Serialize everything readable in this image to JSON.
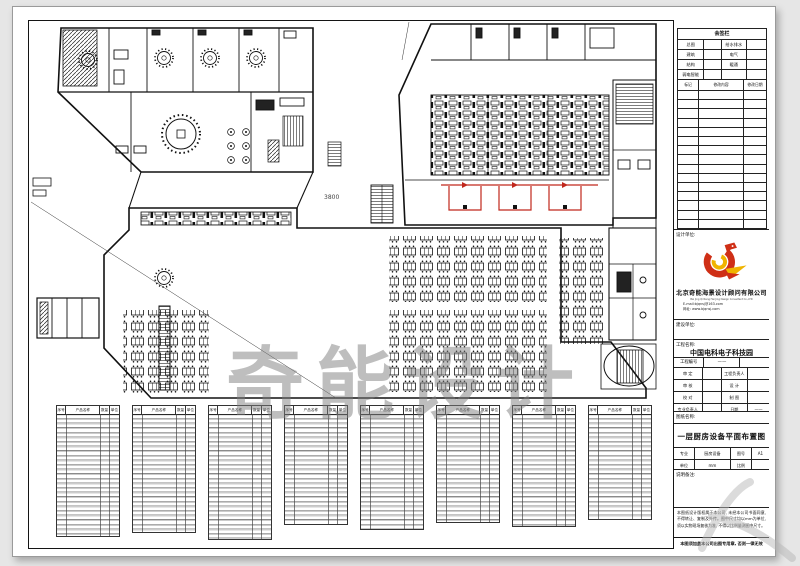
{
  "watermark": {
    "text": "奇能设计"
  },
  "plan": {
    "dim_label": "3800",
    "buffet_color": "#c0271c"
  },
  "signoff": {
    "title": "会签栏",
    "rows": [
      [
        "总图",
        "给水排水"
      ],
      [
        "建筑",
        "电气"
      ],
      [
        "结构",
        "暖通"
      ],
      [
        "弱电智能",
        ""
      ]
    ],
    "rev_headers": [
      "标记",
      "修改内容",
      "修改日期"
    ]
  },
  "design_unit": {
    "label": "设计单位:",
    "company_cn": "北京奇能海景设计顾问有限公司",
    "company_en": "Bei Jing Qi Neng Hai Jing Design Consultant Co.,LTD",
    "email": "E-mail:bjqnsj@163.com",
    "website": "网址: www.bjqnsj.com"
  },
  "project": {
    "owner_label": "建设单位:",
    "name_label": "工程名称:",
    "name": "中国电科电子科技园",
    "no_label": "工程编号",
    "no_value": "——",
    "approvals": [
      {
        "l": "审 定",
        "r": "工程负责人",
        "rv": ""
      },
      {
        "l": "审 核",
        "r": "设 计",
        "rv": ""
      },
      {
        "l": "校 对",
        "r": "制 图",
        "rv": ""
      },
      {
        "l": "专业负责人",
        "r": "日期",
        "rv": "——"
      }
    ]
  },
  "sheet": {
    "name_label": "图纸名称:",
    "title": "一层厨房设备平面布置图",
    "spec_rows": [
      [
        "专业",
        "厨房设备",
        "图号",
        "A1"
      ],
      [
        "单位",
        "mm",
        "比例",
        ""
      ]
    ],
    "remark_label": "说明备注:",
    "notes": "本图纸设计版权属于本公司, 未经本公司书面同意, 不得转让、复制及外传。图中尺寸均以mm为单位, 须以实物现场复核为准, 不得以比例量测图中尺寸。",
    "stamp_note": "本图须加盖本公司出图专用章, 否则一律无效"
  },
  "equip": {
    "headers": [
      "序号",
      "产品名称",
      "数量",
      "单位"
    ]
  },
  "logo": {
    "red": "#cf2f16",
    "yellow": "#f0b400"
  }
}
